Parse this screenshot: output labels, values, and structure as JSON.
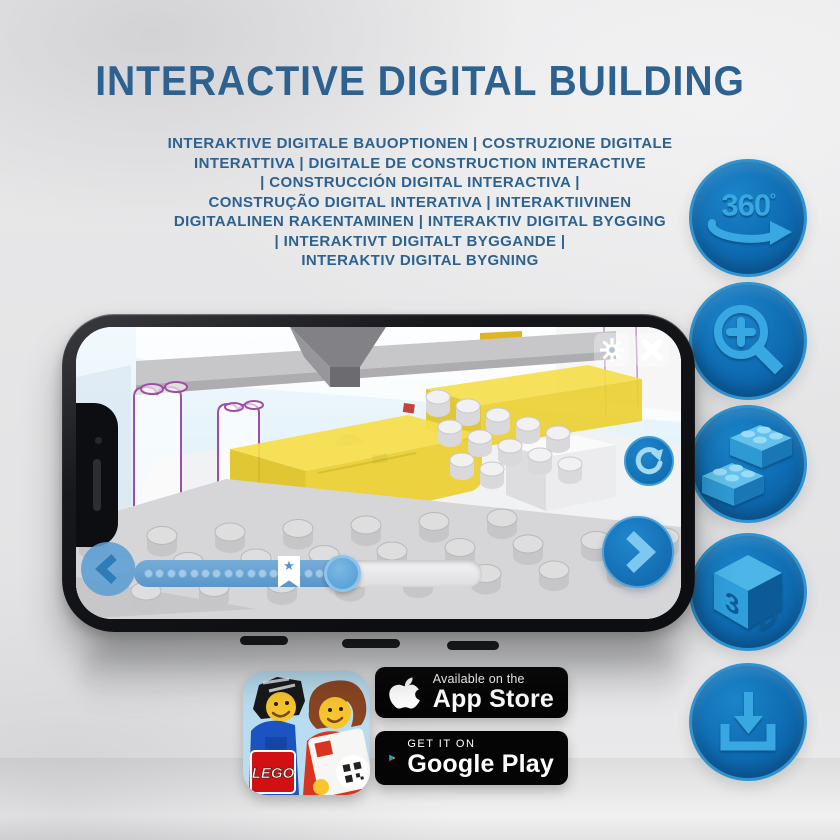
{
  "header": {
    "title": "INTERACTIVE DIGITAL BUILDING"
  },
  "subtitle": {
    "lines": [
      "INTERAKTIVE DIGITALE BAUOPTIONEN | COSTRUZIONE DIGITALE",
      "INTERATTIVA | DIGITALE DE CONSTRUCTION INTERACTIVE",
      "| CONSTRUCCIÓN DIGITAL INTERACTIVA |",
      "CONSTRUÇÃO DIGITAL INTERATIVA | INTERAKTIIVINEN",
      "DIGITAALINEN RAKENTAMINEN | INTERAKTIV DIGITAL BYGGING",
      "| INTERAKTIVT DIGITALT BYGGANDE |",
      "INTERAKTIV DIGITAL BYGNING"
    ]
  },
  "feature_buttons": [
    {
      "id": "rotate-360",
      "icon": "360-rotate-icon",
      "label": "360",
      "degree": "º"
    },
    {
      "id": "zoom-in",
      "icon": "zoom-in-icon"
    },
    {
      "id": "bricks",
      "icon": "lego-bricks-icon"
    },
    {
      "id": "view-3d",
      "icon": "3d-cube-icon",
      "cube_left": "3",
      "cube_right": "D"
    },
    {
      "id": "download",
      "icon": "download-icon"
    }
  ],
  "phone_app": {
    "icons": {
      "settings": "gear",
      "close": "x-cross",
      "rotate": "circular-arrow",
      "previous": "chevron-left",
      "next": "chevron-right",
      "progress_marker_star": "★"
    },
    "slider": {
      "progress_percent": 62,
      "marker_percent": 44,
      "dot_count": 16
    }
  },
  "badges": {
    "app_store": {
      "line1": "Available on the",
      "line2": "App Store"
    },
    "google_play": {
      "line1": "GET IT ON",
      "line2": "Google Play"
    }
  },
  "app_icon": {
    "lego_logo": "LEGO"
  },
  "colors": {
    "title_blue": "#2d6290",
    "circle_fill": "#0e6bb1",
    "circle_ring": "#2f93cf",
    "icon_light_blue": "#37a8e2",
    "badge_black": "#050505",
    "lego_red": "#d01012",
    "brick_yellow": "#f2d73f",
    "screen_sky": "#ddeef9"
  }
}
